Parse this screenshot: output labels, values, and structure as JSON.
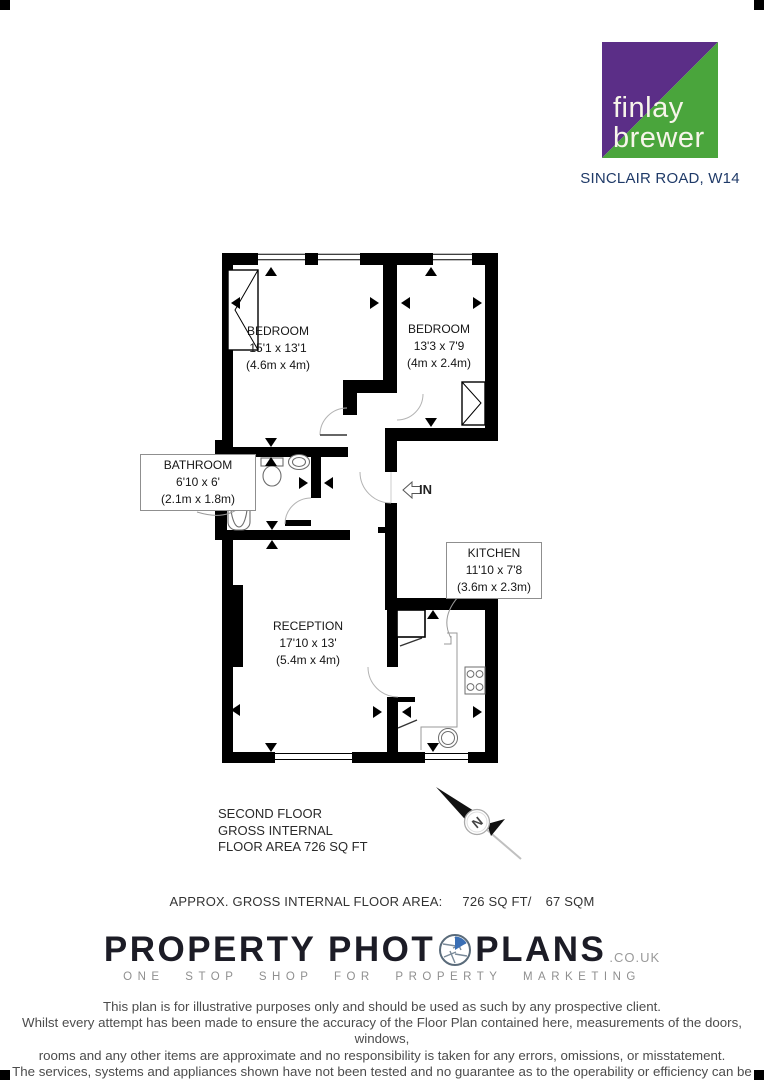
{
  "agency": {
    "logo_top": "finlay",
    "logo_bottom": "brewer",
    "address": "SINCLAIR ROAD, W14",
    "colors": {
      "purple": "#5b2e87",
      "green": "#4aa53c",
      "navy": "#1f3a68"
    }
  },
  "plan": {
    "entrance_label": "IN",
    "rooms": [
      {
        "name": "BEDROOM",
        "imperial": "15'1 x 13'1",
        "metric": "(4.6m x 4m)"
      },
      {
        "name": "BEDROOM",
        "imperial": "13'3 x 7'9",
        "metric": "(4m x 2.4m)"
      },
      {
        "name": "BATHROOM",
        "imperial": "6'10 x 6'",
        "metric": "(2.1m x 1.8m)"
      },
      {
        "name": "RECEPTION",
        "imperial": "17'10 x 13'",
        "metric": "(5.4m x 4m)"
      },
      {
        "name": "KITCHEN",
        "imperial": "11'10 x 7'8",
        "metric": "(3.6m x 2.3m)"
      }
    ]
  },
  "summary": {
    "line1": "SECOND FLOOR",
    "line2": "GROSS INTERNAL",
    "line3": "FLOOR AREA 726 SQ FT"
  },
  "compass": {
    "north_label": "N"
  },
  "area_line": {
    "label": "APPROX. GROSS INTERNAL FLOOR AREA:",
    "imperial": "726 SQ FT/",
    "metric": "67 SQM"
  },
  "footer": {
    "brand_left": "PROPERTY PHOT",
    "brand_right": "PLANS",
    "brand_suffix": ".CO.UK",
    "tagline": "ONE STOP SHOP FOR PROPERTY MARKETING",
    "aperture_blue": "#3a6fb5"
  },
  "disclaimer": {
    "line1": "This plan is for illustrative purposes only and should be used as such by any prospective client.",
    "line2": "Whilst every attempt has been made to ensure the accuracy of the Floor Plan contained here, measurements of the doors, windows,",
    "line3": "rooms and any other items are approximate and no responsibility is taken for any errors, omissions, or misstatement.",
    "line4": "The services, systems and appliances shown have not been tested and no guarantee as to the operability or efficiency can be given."
  }
}
